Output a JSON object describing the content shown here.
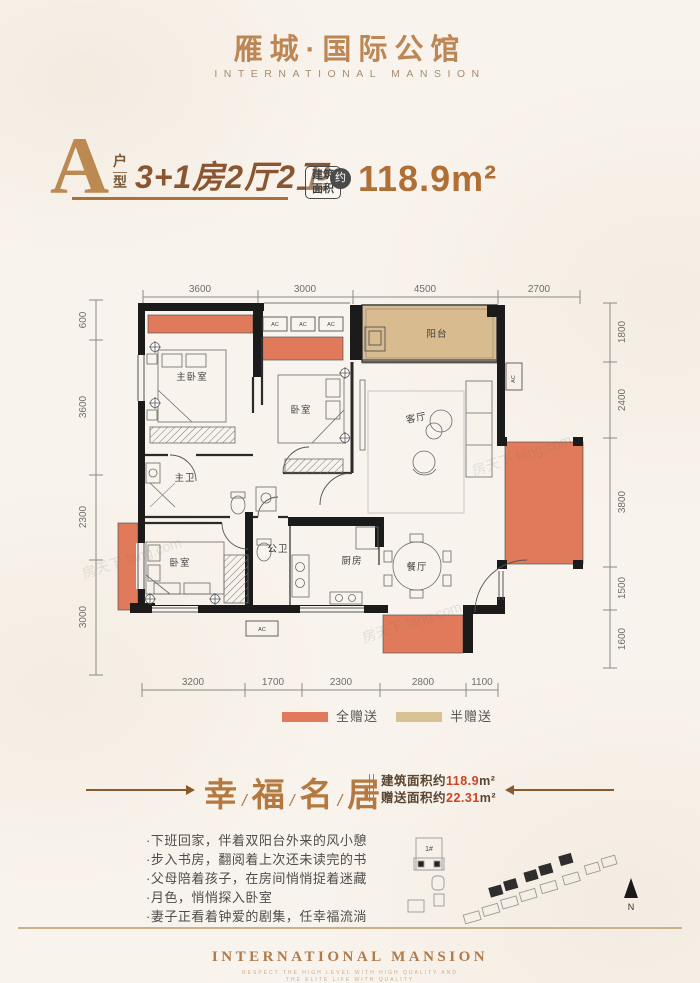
{
  "header": {
    "title": "雁城·国际公馆",
    "subtitle": "INTERNATIONAL MANSION"
  },
  "unit": {
    "letter": "A",
    "letter_suffix_1": "户",
    "letter_suffix_2": "型",
    "layout": "3+1房2厅2卫",
    "badge_line1": "建筑",
    "badge_line2": "面积",
    "badge_approx": "约",
    "area": "118.9m²"
  },
  "plan": {
    "dims_top": [
      "3600",
      "3000",
      "4500",
      "2700"
    ],
    "dims_bottom": [
      "3200",
      "1700",
      "2300",
      "2800",
      "1100"
    ],
    "dims_left": [
      "600",
      "3600",
      "2300",
      "3000"
    ],
    "dims_right": [
      "1800",
      "2400",
      "3800",
      "1500",
      "1600"
    ],
    "rooms": {
      "master_bedroom": "主卧室",
      "bedroom2": "卧室",
      "living_room": "客厅",
      "balcony": "阳台",
      "master_bath": "主卫",
      "bedroom3": "卧室",
      "shared_bath": "公卫",
      "kitchen": "厨房",
      "dining_room": "餐厅"
    },
    "ac_label": "AC"
  },
  "legend": {
    "full_gift": "全赠送",
    "half_gift": "半赠送"
  },
  "banner": {
    "chars": [
      "幸",
      "福",
      "名",
      "居"
    ],
    "separator": "/",
    "area_label": "建筑面积约",
    "area_value": "118.9",
    "area_unit": "m²",
    "gift_label": "赠送面积约",
    "gift_value": "22.31",
    "gift_unit": "m²"
  },
  "bullets": [
    "·下班回家，伴着双阳台外来的风小憩",
    "·步入书房，翻阅着上次还未读完的书",
    "·父母陪着孩子，在房间悄悄捉着迷藏",
    "·月色，悄悄探入卧室",
    "·妻子正看着钟爱的剧集，任幸福流淌"
  ],
  "site": {
    "building": "1#",
    "north": "N"
  },
  "footer": {
    "title": "INTERNATIONAL MANSION",
    "tagline1": "RESPECT THE HIGH LEVEL WITH HIGH QUALITY AND",
    "tagline2": "THE ELITE LIFE WITH QUALITY"
  },
  "watermark": "房天下 fang.com",
  "colors": {
    "gold": "#b5793f",
    "orange": "#e07a5a",
    "tan": "#d8bb8e",
    "red": "#cd4326",
    "wall": "#1b1b1b"
  }
}
